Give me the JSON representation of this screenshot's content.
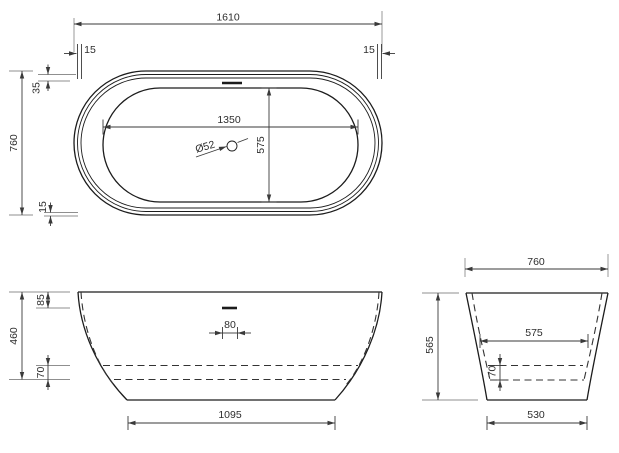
{
  "top_view": {
    "overall_length": "1610",
    "overall_width": "760",
    "rim_left": "15",
    "rim_right": "15",
    "rim_offset": "35",
    "rim_bottom": "15",
    "inner_length": "1350",
    "inner_width": "575",
    "drain_diameter": "Ø52"
  },
  "front_view": {
    "height": "460",
    "rim_height": "85",
    "floor_offset": "70",
    "overflow_width": "80",
    "base_length": "1095"
  },
  "side_view": {
    "top_width": "760",
    "height": "565",
    "inner_width": "575",
    "floor_offset": "70",
    "base_width": "530"
  },
  "colors": {
    "line": "#1c1c1c",
    "dimension": "#3a3a3a",
    "background": "#ffffff"
  }
}
